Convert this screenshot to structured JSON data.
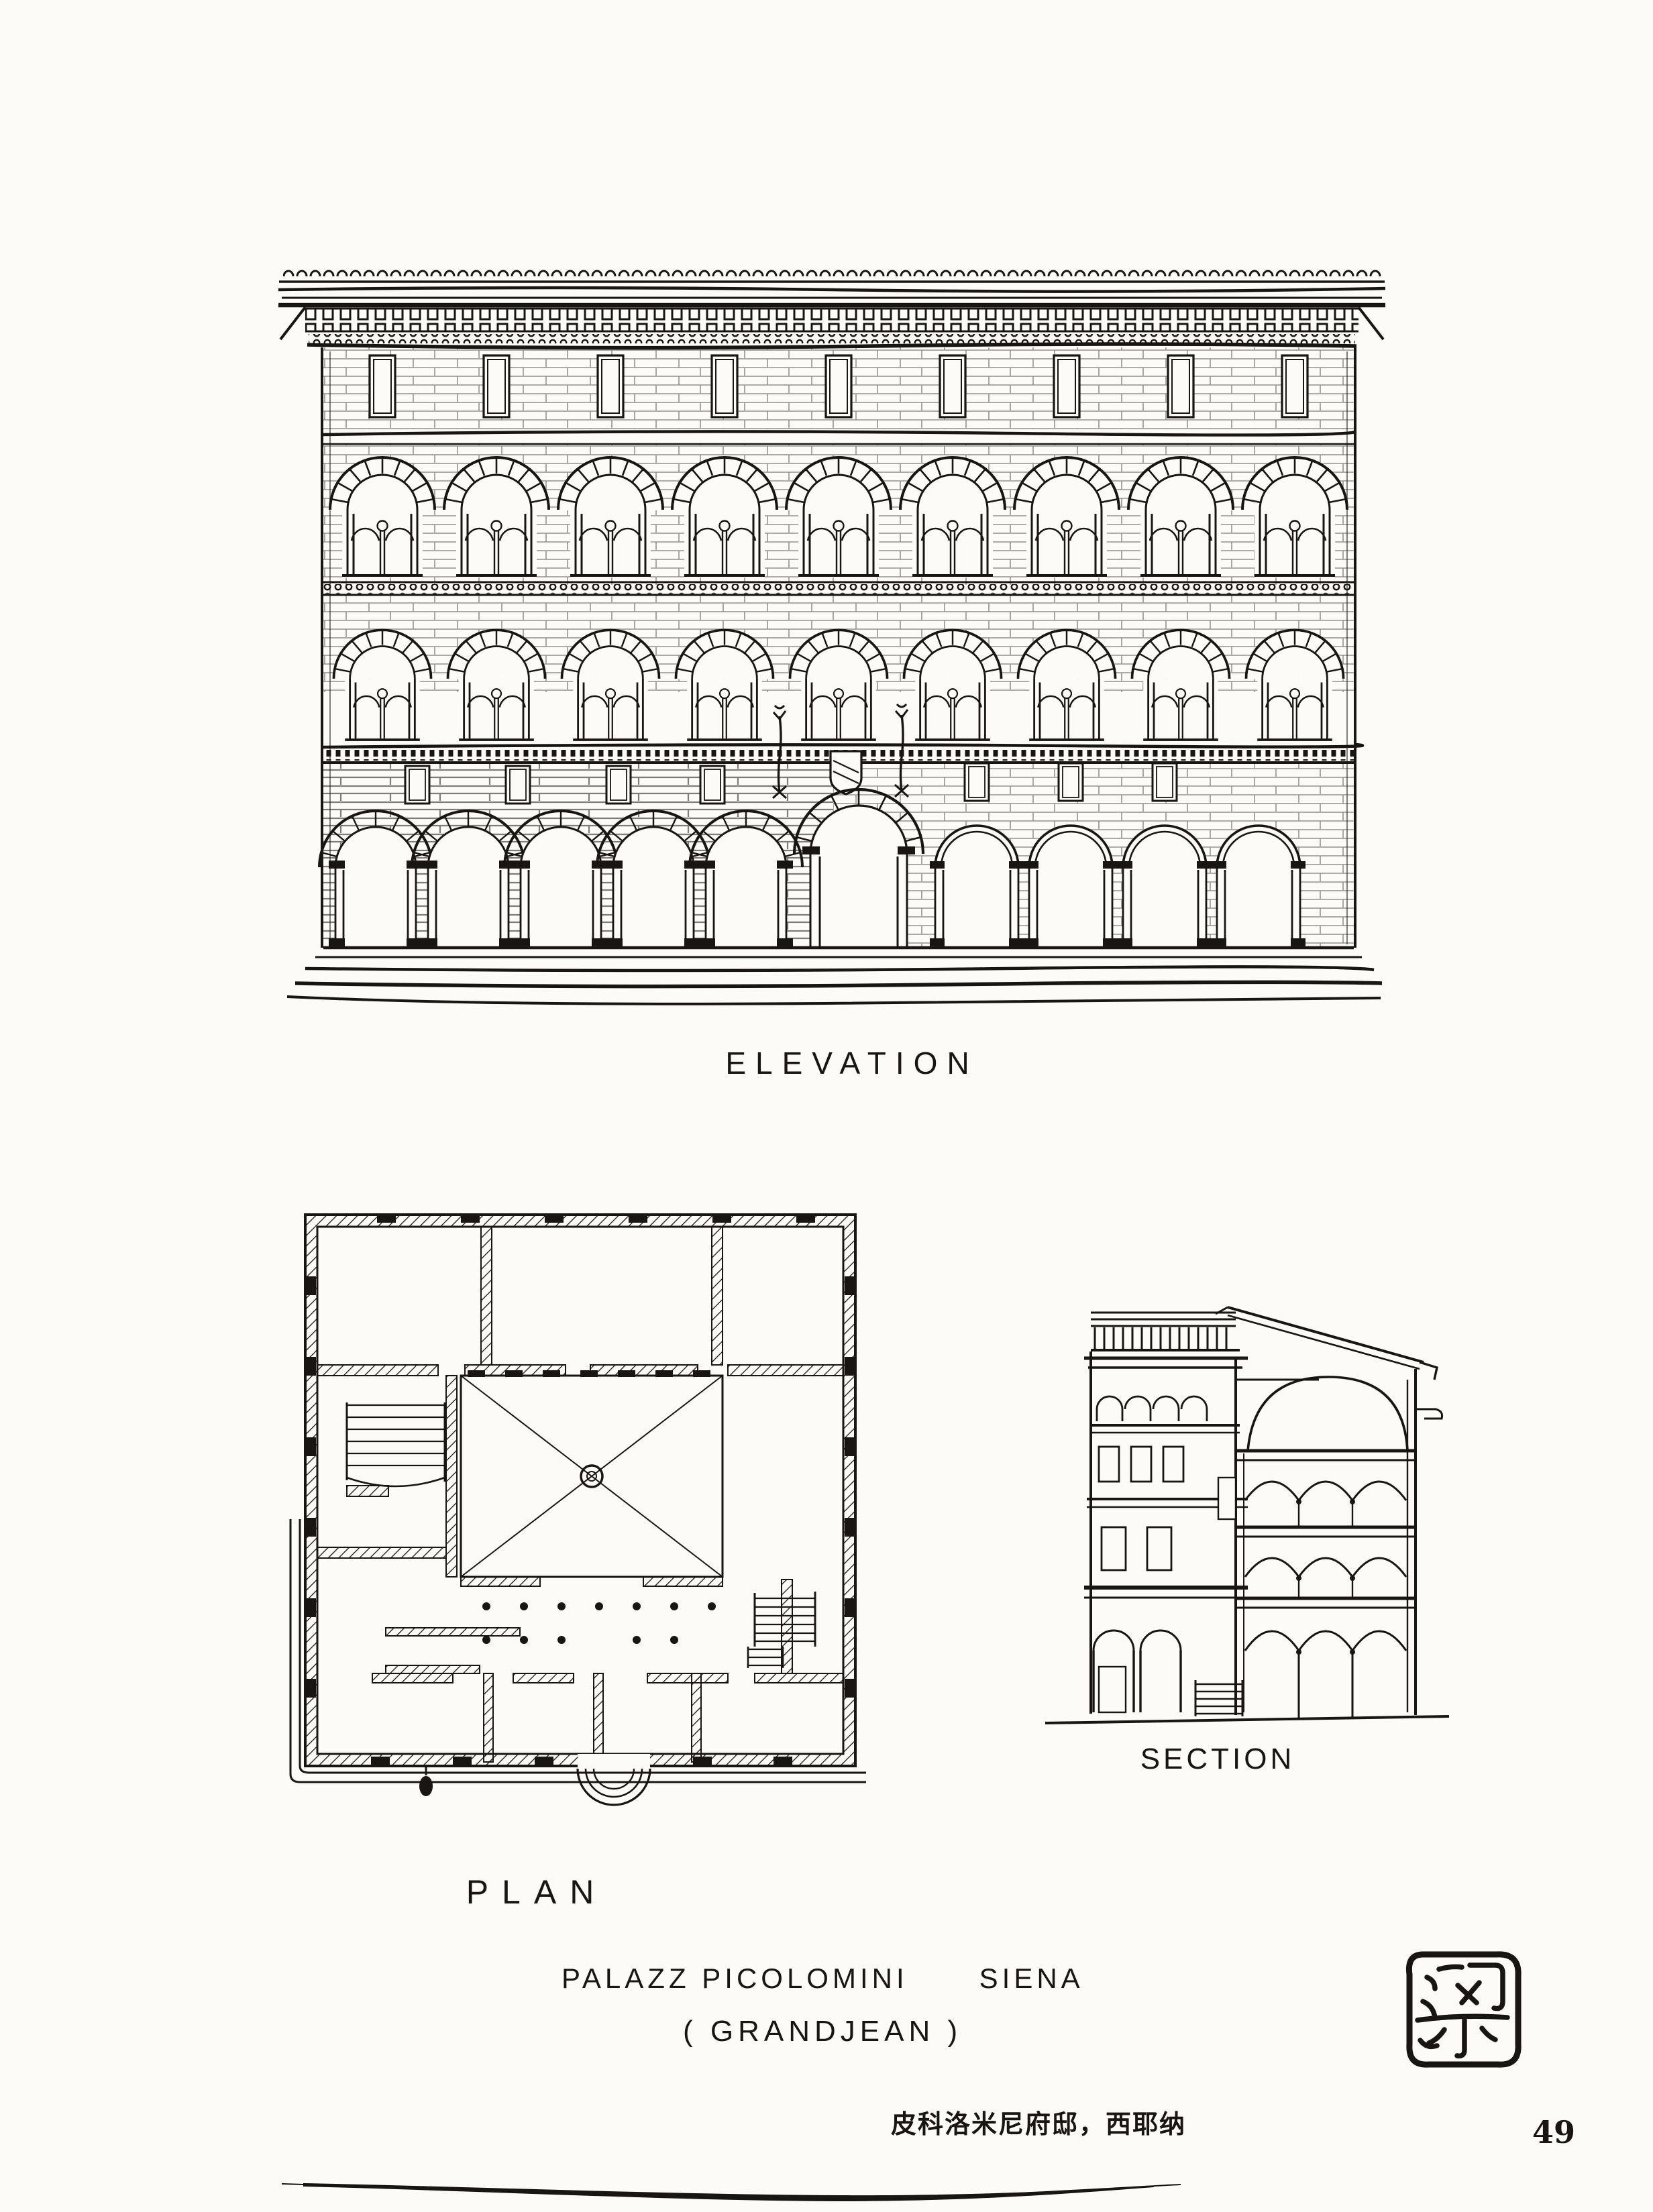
{
  "page": {
    "number": "49",
    "paper_color": "#fcfbf8",
    "ink_color": "#181512"
  },
  "labels": {
    "elevation": "ELEVATION",
    "plan": "PLAN",
    "section": "SECTION"
  },
  "caption": {
    "title": "PALAZZ PICOLOMINI      SIENA",
    "credit": "( GRANDJEAN )",
    "chinese": "皮科洛米尼府邸，西耶纳"
  },
  "seal": {
    "character": "梁"
  },
  "figures": {
    "elevation_name": "palazzo-facade-elevation-sketch",
    "plan_name": "palazzo-floor-plan-sketch",
    "section_name": "palazzo-cross-section-sketch"
  }
}
